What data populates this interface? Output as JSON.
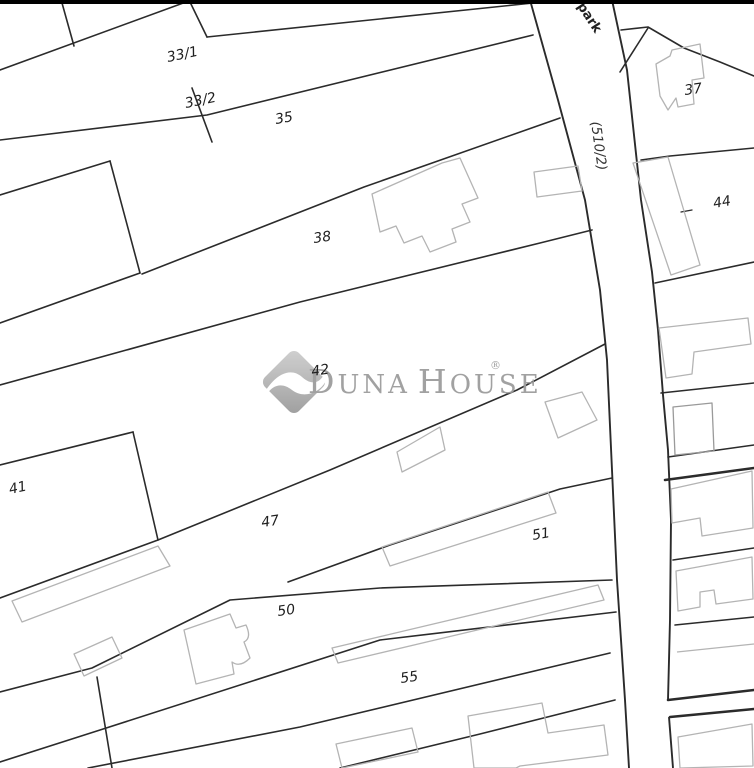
{
  "map": {
    "kind": "cadastral-parcel-map",
    "topbar": true
  },
  "colors": {
    "bg": "#ffffff",
    "line": "#2b2b2b",
    "building": "#b4b4b4",
    "label": "#1f1f1f",
    "watermark": "#9c9c9c",
    "topbar": "#000000"
  },
  "parcels": [
    {
      "label": "33/1",
      "x": 168,
      "y": 62,
      "rot": -12
    },
    {
      "label": "33/2",
      "x": 186,
      "y": 108,
      "rot": -12
    },
    {
      "label": "35",
      "x": 276,
      "y": 124,
      "rot": -10
    },
    {
      "label": "38",
      "x": 314,
      "y": 243,
      "rot": -8
    },
    {
      "label": "42",
      "x": 312,
      "y": 376,
      "rot": -8
    },
    {
      "label": "41",
      "x": 10,
      "y": 494,
      "rot": -12
    },
    {
      "label": "47",
      "x": 262,
      "y": 527,
      "rot": -8
    },
    {
      "label": "51",
      "x": 533,
      "y": 540,
      "rot": -10
    },
    {
      "label": "50",
      "x": 278,
      "y": 616,
      "rot": -8
    },
    {
      "label": "55",
      "x": 401,
      "y": 683,
      "rot": -8
    },
    {
      "label": "37",
      "x": 685,
      "y": 95,
      "rot": -8
    },
    {
      "label": "44",
      "x": 714,
      "y": 208,
      "rot": -10
    }
  ],
  "road": {
    "label": "(510/2)",
    "label_x": 591,
    "label_y": 122,
    "label_rot": 82,
    "street_label": "park",
    "street_x": 577,
    "street_y": 6,
    "street_rot": 57
  },
  "watermark": {
    "word1_initial": "D",
    "word1_rest": "UNA",
    "word2_initial": "H",
    "word2_rest": "OUSE",
    "registered": "®"
  }
}
